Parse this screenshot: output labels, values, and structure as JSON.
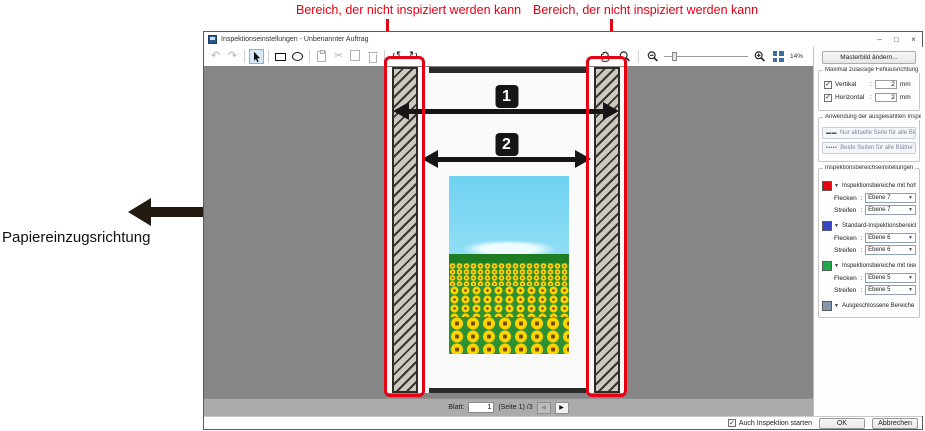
{
  "annotations": {
    "label_left": "Bereich, der nicht inspiziert werden kann",
    "label_right": "Bereich, der nicht inspiziert werden kann",
    "feed_direction": "Papiereinzugsrichtung",
    "marker_1": "1",
    "marker_2": "2",
    "red": "#e60012"
  },
  "window": {
    "title": "Inspektionseinstellungen - Unbenannter Auftrag",
    "minimize": "–",
    "maximize": "□",
    "close": "×"
  },
  "toolbar": {
    "icons": {
      "undo": "↶",
      "redo": "↷",
      "cut": "✂",
      "rotate_left": "↺",
      "rotate_right": "↻"
    },
    "zoom_percent": "14%"
  },
  "strings": {
    "colon": ":"
  },
  "right_panel": {
    "master_button": "Masterbild ändern...",
    "misalignment": {
      "title": "Maximal zulässige Fehlausrichtung",
      "rows": [
        {
          "label": "Vertikal",
          "value": "2",
          "unit": "mm"
        },
        {
          "label": "Horizontal",
          "value": "2",
          "unit": "mm"
        }
      ]
    },
    "apply": {
      "title": "Anwendung der ausgewählten Inspektionsbereiche",
      "buttons": [
        {
          "icon": "▬▬",
          "label": "Nur aktuelle Seite für alle Blätter"
        },
        {
          "icon": "•••••",
          "label": "Beide Seiten für alle Blätter"
        }
      ]
    },
    "areas": {
      "title": "Inspektionsbereichseinstellungen",
      "caret": "▼",
      "groups": [
        {
          "color": "#e8000d",
          "label": "Inspektionsbereiche mit hoher Priorität",
          "rows": [
            {
              "label": "Flecken",
              "value": "Ebene 7"
            },
            {
              "label": "Streifen",
              "value": "Ebene 7"
            }
          ]
        },
        {
          "color": "#3743c5",
          "label": "Standard-Inspektionsbereiche",
          "rows": [
            {
              "label": "Flecken",
              "value": "Ebene 6"
            },
            {
              "label": "Streifen",
              "value": "Ebene 6"
            }
          ]
        },
        {
          "color": "#22a84e",
          "label": "Inspektionsbereiche mit niedriger Priorität",
          "rows": [
            {
              "label": "Flecken",
              "value": "Ebene 5"
            },
            {
              "label": "Streifen",
              "value": "Ebene 5"
            }
          ]
        },
        {
          "color": "#8399ab",
          "label": "Ausgeschlossene Bereiche",
          "rows": []
        }
      ]
    }
  },
  "navbar": {
    "sheet_label": "Blatt:",
    "sheet_value": "1",
    "page_info": "(Seite 1) /3",
    "prev": "◀",
    "next": "▶"
  },
  "footer": {
    "check": "✓",
    "start_inspection": "Auch Inspektion starten",
    "ok": "OK",
    "cancel": "Abbrechen"
  }
}
